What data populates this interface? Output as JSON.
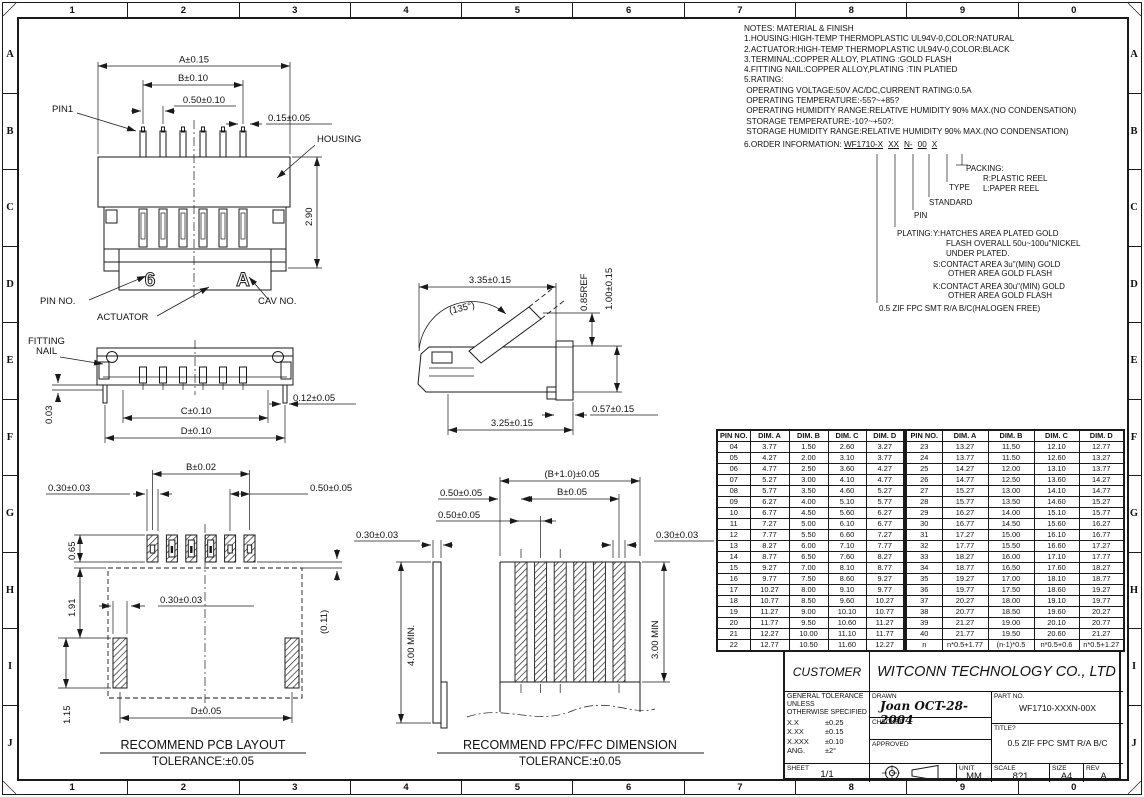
{
  "border": {
    "columns": [
      "1",
      "2",
      "3",
      "4",
      "5",
      "6",
      "7",
      "8",
      "9",
      "0"
    ],
    "rows": [
      "A",
      "B",
      "C",
      "D",
      "E",
      "F",
      "G",
      "H",
      "I",
      "J"
    ]
  },
  "notes": {
    "title": "NOTES: MATERIAL & FINISH",
    "lines": [
      "1.HOUSING:HIGH-TEMP THERMOPLASTIC UL94V-0,COLOR:NATURAL",
      "2.ACTUATOR:HIGH-TEMP THERMOPLASTIC UL94V-0,COLOR:BLACK",
      "3.TERMINAL:COPPER ALLOY, PLATING :GOLD FLASH",
      "4.FITTING NAIL:COPPER ALLOY,PLATING :TIN PLATIED",
      "5.RATING:",
      " OPERATING VOLTAGE:50V AC/DC,CURRENT RATING:0.5A",
      " OPERATING TEMPERATURE:-55?~+85?",
      " OPERATING HUMIDITY RANGE:RELATIVE HUMIDITY 90% MAX.(NO CONDENSATION)",
      " STORAGE TEMPERATURE:-10?~+50?:",
      " STORAGE HUMIDITY RANGE:RELATIVE HUMIDITY 90% MAX.(NO CONDENSATION)"
    ],
    "order_label": "6.ORDER INFORMATION:",
    "order_code_parts": [
      "WF1710-X",
      "XX",
      "N-",
      "00",
      "X"
    ]
  },
  "order_tree": {
    "packing_label": "PACKING:",
    "packing_options": [
      "R:PLASTIC REEL",
      "L:PAPER REEL"
    ],
    "type_label": "TYPE",
    "standard_label": "STANDARD",
    "pin_label": "PIN",
    "plating_label": "PLATING:",
    "plating_y": [
      "Y:HATCHES AREA PLATED GOLD",
      "FLASH OVERALL 50u~100u\"NICKEL",
      "UNDER PLATED."
    ],
    "plating_s": [
      "S:CONTACT AREA 3u\"(MIN) GOLD",
      "OTHER AREA GOLD FLASH"
    ],
    "plating_k": [
      "K:CONTACT AREA 30u\"(MIN) GOLD",
      "OTHER AREA GOLD FLASH"
    ],
    "series_desc": "0.5 ZIF FPC SMT R/A B/C(HALOGEN FREE)"
  },
  "views": {
    "front": {
      "dim_a": "A±0.15",
      "dim_b": "B±0.10",
      "pitch": "0.50±0.10",
      "pin_width": "0.15±0.05",
      "pin1": "PIN1",
      "housing": "HOUSING",
      "height": "2.90",
      "pin_no": "PIN NO.",
      "actuator": "ACTUATOR",
      "cav_no": "CAV NO.",
      "pin_mark": "6",
      "cav_mark": "A"
    },
    "mount": {
      "fitting_nail_1": "FITTING",
      "fitting_nail_2": "NAIL",
      "standoff": "0.03",
      "dim_c": "C±0.10",
      "dim_d": "D±0.10",
      "nail_width": "0.12±0.05"
    },
    "side": {
      "open_depth": "3.35±0.15",
      "angle": "(135°)",
      "ref_height": "0.85REF",
      "height": "1.00±0.15",
      "depth": "3.25±0.15",
      "tail": "0.57±0.15"
    },
    "pcb": {
      "dim_b": "B±0.02",
      "pad_width": "0.30±0.03",
      "pad_pitch": "0.50±0.05",
      "pad_length": "0.65",
      "gap": "1.91",
      "nail_pad_width": "0.30±0.03",
      "offset": "(0.11)",
      "nail_pad_length": "1.15",
      "dim_d": "D±0.05",
      "caption": "RECOMMEND PCB LAYOUT",
      "tolerance": "TOLERANCE:±0.05"
    },
    "fpc": {
      "overall_width": "(B+1.0)±0.05",
      "edge_margin": "0.50±0.05",
      "dim_b": "B±0.05",
      "pitch": "0.50±0.05",
      "thickness": "0.30±0.03",
      "finger_width": "0.30±0.03",
      "length": "4.00 MIN.",
      "exposed": "3.00 MIN",
      "caption": "RECOMMEND FPC/FFC DIMENSION",
      "tolerance": "TOLERANCE:±0.05"
    }
  },
  "dim_table": {
    "headers": [
      "PIN NO.",
      "DIM. A",
      "DIM. B",
      "DIM. C",
      "DIM. D"
    ],
    "left_rows": [
      [
        "04",
        "3.77",
        "1.50",
        "2.60",
        "3.27"
      ],
      [
        "05",
        "4.27",
        "2.00",
        "3.10",
        "3.77"
      ],
      [
        "06",
        "4.77",
        "2.50",
        "3.60",
        "4.27"
      ],
      [
        "07",
        "5.27",
        "3.00",
        "4.10",
        "4.77"
      ],
      [
        "08",
        "5.77",
        "3.50",
        "4.60",
        "5.27"
      ],
      [
        "09",
        "6.27",
        "4.00",
        "5.10",
        "5.77"
      ],
      [
        "10",
        "6.77",
        "4.50",
        "5.60",
        "6.27"
      ],
      [
        "11",
        "7.27",
        "5.00",
        "6.10",
        "6.77"
      ],
      [
        "12",
        "7.77",
        "5.50",
        "6.60",
        "7.27"
      ],
      [
        "13",
        "8.27",
        "6.00",
        "7.10",
        "7.77"
      ],
      [
        "14",
        "8.77",
        "6.50",
        "7.60",
        "8.27"
      ],
      [
        "15",
        "9.27",
        "7.00",
        "8.10",
        "8.77"
      ],
      [
        "16",
        "9.77",
        "7.50",
        "8.60",
        "9.27"
      ],
      [
        "17",
        "10.27",
        "8.00",
        "9.10",
        "9.77"
      ],
      [
        "18",
        "10.77",
        "8.50",
        "9.60",
        "10.27"
      ],
      [
        "19",
        "11.27",
        "9.00",
        "10.10",
        "10.77"
      ],
      [
        "20",
        "11.77",
        "9.50",
        "10.60",
        "11.27"
      ],
      [
        "21",
        "12.27",
        "10.00",
        "11.10",
        "11.77"
      ],
      [
        "22",
        "12.77",
        "10.50",
        "11.60",
        "12.27"
      ]
    ],
    "right_rows": [
      [
        "23",
        "13.27",
        "11.50",
        "12.10",
        "12.77"
      ],
      [
        "24",
        "13.77",
        "11.50",
        "12.60",
        "13.27"
      ],
      [
        "25",
        "14.27",
        "12.00",
        "13.10",
        "13.77"
      ],
      [
        "26",
        "14.77",
        "12.50",
        "13.60",
        "14.27"
      ],
      [
        "27",
        "15.27",
        "13.00",
        "14.10",
        "14.77"
      ],
      [
        "28",
        "15.77",
        "13.50",
        "14.60",
        "15.27"
      ],
      [
        "29",
        "16.27",
        "14.00",
        "15.10",
        "15.77"
      ],
      [
        "30",
        "16.77",
        "14.50",
        "15.60",
        "16.27"
      ],
      [
        "31",
        "17.27",
        "15.00",
        "16.10",
        "16.77"
      ],
      [
        "32",
        "17.77",
        "15.50",
        "16.60",
        "17.27"
      ],
      [
        "33",
        "18.27",
        "16.00",
        "17.10",
        "17.77"
      ],
      [
        "34",
        "18.77",
        "16.50",
        "17.60",
        "18.27"
      ],
      [
        "35",
        "19.27",
        "17.00",
        "18.10",
        "18.77"
      ],
      [
        "36",
        "19.77",
        "17.50",
        "18.60",
        "19.27"
      ],
      [
        "37",
        "20.27",
        "18.00",
        "19.10",
        "19.77"
      ],
      [
        "38",
        "20.77",
        "18.50",
        "19.60",
        "20.27"
      ],
      [
        "39",
        "21.27",
        "19.00",
        "20.10",
        "20.77"
      ],
      [
        "40",
        "21.77",
        "19.50",
        "20.60",
        "21.27"
      ],
      [
        "n",
        "n*0.5+1.77",
        "(n-1)*0.5",
        "n*0.5+0.6",
        "n*0.5+1.27"
      ]
    ]
  },
  "title_block": {
    "customer_label": "CUSTOMER",
    "company": "WITCONN TECHNOLOGY CO., LTD",
    "tol_note_1": "GENERAL TOLERANCE",
    "tol_note_2": "UNLESS",
    "tol_note_3": "OTHERWISE SPECIFIED",
    "tol_rows": [
      [
        "X.X",
        "±0.25"
      ],
      [
        "X.XX",
        "±0.15"
      ],
      [
        "X.XXX",
        "±0.10"
      ],
      [
        "ANG.",
        "±2°"
      ]
    ],
    "drawn_label": "DRAWN",
    "drawn_value": "Joan OCT-28-2004",
    "checked_label": "CHECKED",
    "approved_label": "APPROVED",
    "part_no_label": "PART NO.",
    "part_no": "WF1710-XXXN-00X",
    "title_label": "TITLE?",
    "title": "0.5 ZIF FPC SMT R/A B/C",
    "sheet_label": "SHEET",
    "sheet": "1/1",
    "unit_label": "UNIT",
    "unit": "MM",
    "scale_label": "SCALE",
    "scale": "8?1",
    "size_label": "SIZE",
    "size": "A4",
    "rev_label": "REV",
    "rev": "A"
  }
}
